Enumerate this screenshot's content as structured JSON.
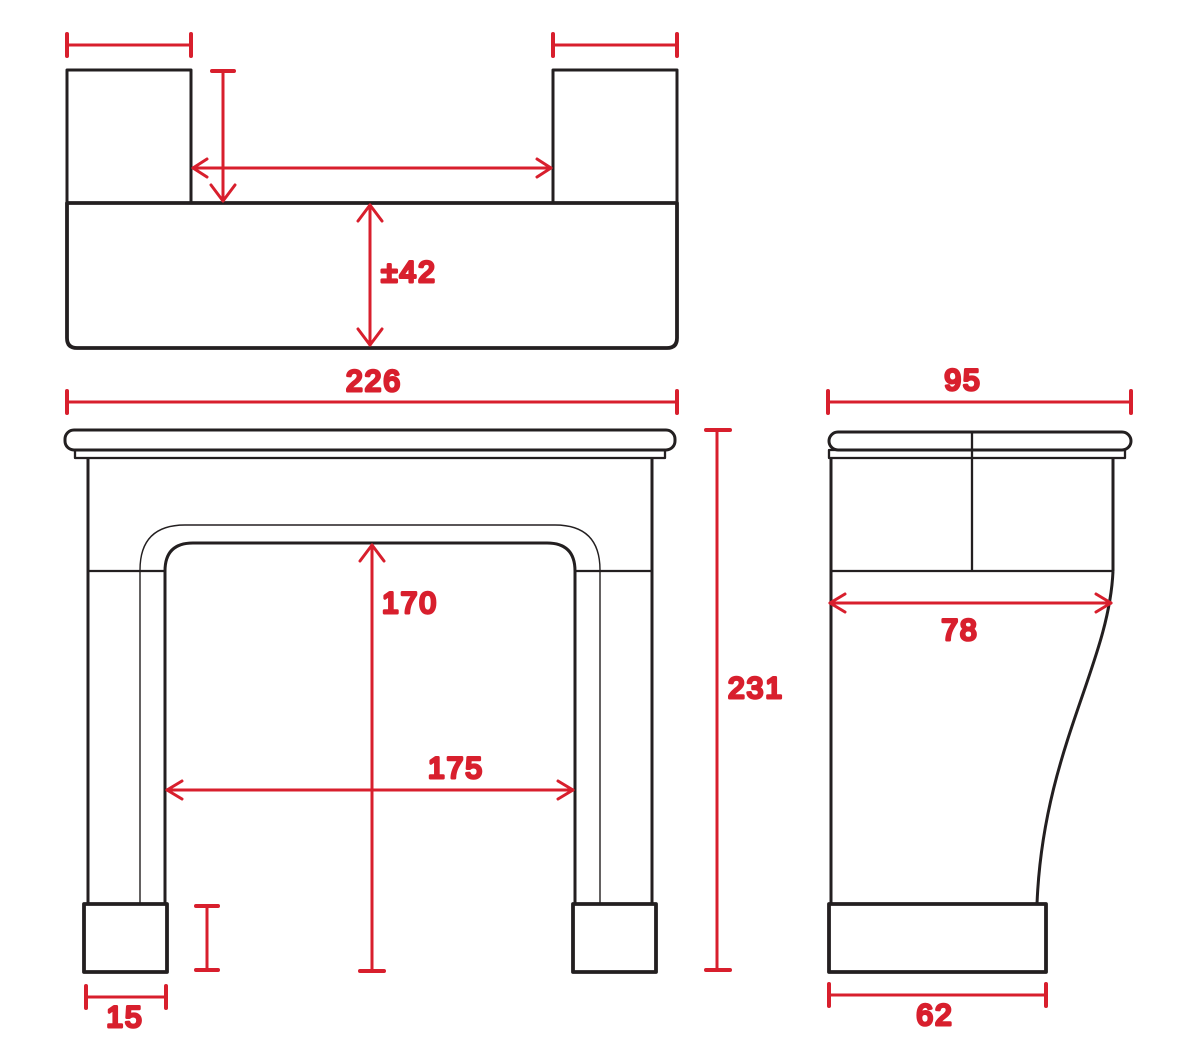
{
  "drawing": {
    "subject": "Fireplace mantel surround — dimensioned orthographic technical drawing (plan, front and side views)",
    "background": "#ffffff",
    "colors": {
      "outline": "#231f20",
      "dimension": "#d81f2d"
    },
    "views": {
      "plan": {
        "name": "plan-view",
        "dimensions": {
          "shelf_depth": "±42"
        }
      },
      "front": {
        "name": "front-view",
        "dimensions": {
          "overall_width": "226",
          "overall_height": "231",
          "opening_height": "170",
          "opening_width": "175",
          "plinth_width": "15"
        }
      },
      "side": {
        "name": "side-view",
        "dimensions": {
          "overall_depth": "95",
          "body_depth": "78",
          "plinth_depth": "62"
        }
      }
    }
  }
}
